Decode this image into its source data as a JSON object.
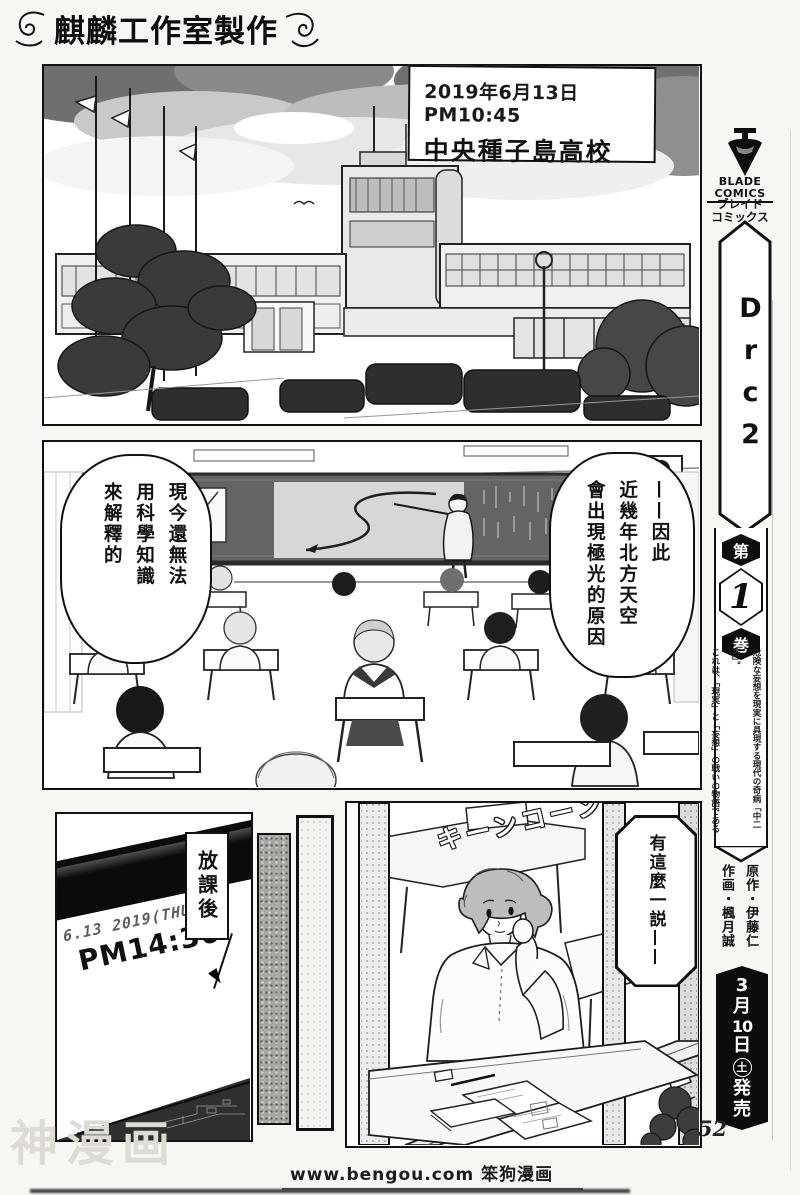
{
  "page": {
    "studio_credit": "麒麟工作室製作",
    "page_number": "52",
    "watermark": "神漫画",
    "site_credit": "www.bengou.com 笨狗漫画"
  },
  "panel_school": {
    "caption_date": "2019年6月13日 PM10:45",
    "caption_school": "中央種子島高校"
  },
  "panel_classroom": {
    "bubble_aurora": {
      "col1": "——因此",
      "col2": "近幾年北方天空",
      "col3": "會出現極光的原因"
    },
    "bubble_science": {
      "col1": "現今還無法",
      "col2": "用科學知識",
      "col3": "來解釋的"
    }
  },
  "panel_clock": {
    "date": "6.13 2019(THU)",
    "time": "PM14:30",
    "caption": "放課後"
  },
  "panel_boy": {
    "sfx": "キーンコーン",
    "bubble": "有這麼一説——"
  },
  "sidebar": {
    "publisher_line1": "BLADE",
    "publisher_line2": "COMICS",
    "publisher_kana1": "ブレイド",
    "publisher_kana2": "コミックス",
    "series_title": "Drc2",
    "volume_prefix": "第",
    "volume_number": "1",
    "volume_suffix": "巻",
    "tagline_col1": "危険な妄想を現実に具現する現代の奇病「中二病」。",
    "tagline_col2": "これは、「現実」と「妄想」の戦いの物語である—",
    "credit_original": "原作・伊藤仁",
    "credit_art": "作画・楓月誠",
    "release_date": "3月10日(土)発売",
    "release_chars": [
      "3",
      "月",
      "10",
      "日",
      "土",
      "発",
      "売"
    ]
  }
}
